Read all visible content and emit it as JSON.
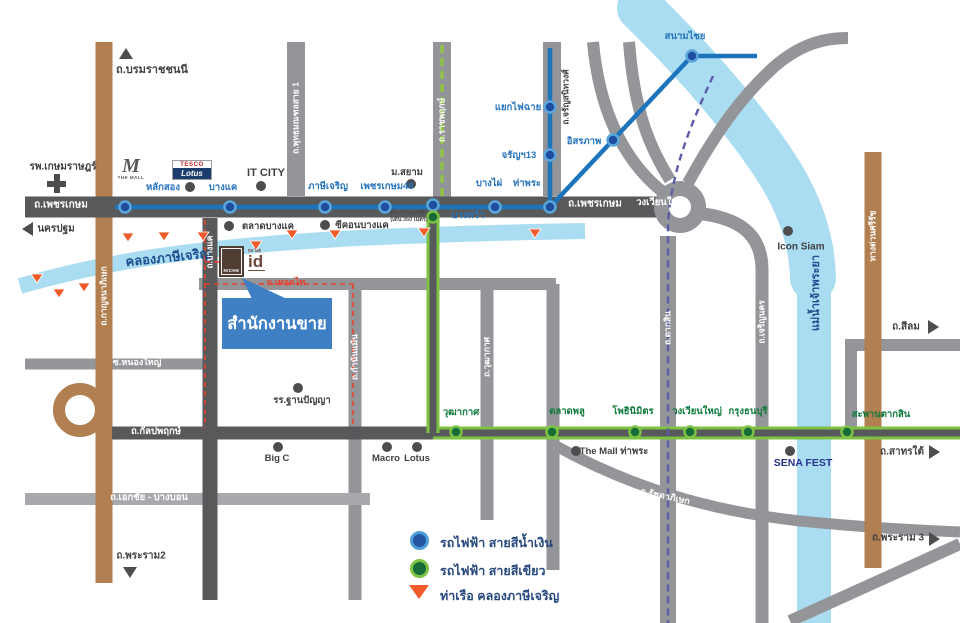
{
  "roads": {
    "borommaratchachonnani": "ถ.บรมราชชนนี",
    "nakhonpathom": "นครปฐม",
    "phetkasem": "ถ.เพชรเกษม",
    "wongwianyai": "วงเวียนใหญ่",
    "kanchanaphisek": "ถ.กาญจนาภิเษก",
    "phutthamonthon1": "ถ.พุทธมณฑลสาย 1",
    "ratchaphruek": "ถ.ราชพฤกษ์",
    "charansanitwong": "ถ.จรัญสนิทวงศ์",
    "bangkhae": "ถ.บางแค",
    "thoetthai": "ถ.เทอดไท",
    "kamnanmaen": "ถ.กำนันแม้น",
    "wutthakat": "ถ.วุฒากาศ",
    "taksin": "ถ.ตากสิน",
    "charoennakhon": "ถ.เจริญนคร",
    "sirat_expressway": "ทางด่วนศรีรัช",
    "silom": "ถ.สีลม",
    "sathon_tai": "ถ.สาทรใต้",
    "rama3": "ถ.พระราม 3",
    "rama2": "ถ.พระราม2",
    "ratchadaphisek": "ถ.รัชดาภิเษก",
    "kanlapaphruek": "ถ.กัลปพฤกษ์",
    "nongyai": "ซ.หนองใหญ่",
    "ekkachai_bangbon": "ถ.เอกชัย - บางบอน"
  },
  "waterways": {
    "canal": "คลองภาษีเจริญ",
    "river": "แม่น้ำเจ้าพระยา"
  },
  "stations": {
    "blue": {
      "laksong": "หลักสอง",
      "bangkhae": "บางแค",
      "phasicharoen": "ภาษีเจริญ",
      "phetkasem48": "เพชรเกษม48",
      "bangphai": "บางไผ่",
      "thapra": "ท่าพระ",
      "charan13": "จรัญฯ13",
      "yaekfaichai": "แยกไฟฉาย",
      "itsaraphap": "อิสรภาพ",
      "sanamchai": "สนามไชย"
    },
    "green": {
      "bangwa": "บางหว้า",
      "wutthakat": "วุฒากาศ",
      "talatphlu": "ตลาดพลู",
      "phonimit": "โพธินิมิตร",
      "wongwianyai": "วงเวียนใหญ่",
      "krungthonburi": "กรุงธนบุรี",
      "saphantaksin": "สะพานตากสิน"
    }
  },
  "pois": {
    "hospital": "รพ.เกษมราษฎร์",
    "themall_mark": "M",
    "themall_text": "THE MALL",
    "tesco": "TESCO",
    "tesco_lotus": "Lotus",
    "itcity": "IT CITY",
    "msiam": "ม.สยาม",
    "talat_bangkhae": "ตลาดบางแค",
    "seacon_bangkhae": "ซีคอนบางแค",
    "icon_siam": "Icon Siam",
    "themall_thapra": "The Mall ท่าพระ",
    "sena_fest": "SENA FEST",
    "bigc": "Big C",
    "macro": "Macro",
    "lotus": "Lotus",
    "school": "รร.ฐานปัญญา"
  },
  "project": {
    "box_label": "NICHE",
    "id_label": "id",
    "id_caption": "นิช ไอดี"
  },
  "sales_office": {
    "label": "สำนักงานขาย"
  },
  "bangwa_note": {
    "line1": "ที่สะพานลอยฟ้า",
    "line2": "(เดิน 350 เมตร)"
  },
  "legend": {
    "blue_line": "รถไฟฟ้า สายสีน้ำเงิน",
    "green_line": "รถไฟฟ้า สายสีเขียว",
    "pier": "ท่าเรือ คลองภาษีเจริญ"
  },
  "colors": {
    "mrt_blue": "#1c75bc",
    "bts_green": "#7dc242",
    "pier_orange": "#f15a29",
    "callout_blue": "#3f80c4",
    "canal_blue": "#aadcf2",
    "road_dark": "#58595b",
    "road_gray": "#939598",
    "road_brown": "#b17f50"
  }
}
